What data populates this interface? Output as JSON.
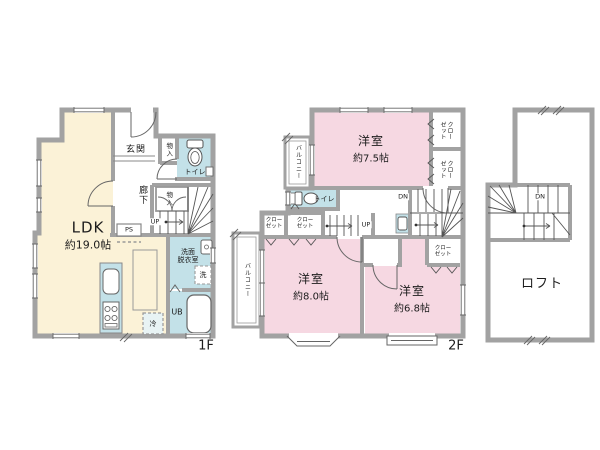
{
  "colors": {
    "room_cream": "#fbf2d7",
    "room_pink": "#f6d8e2",
    "wet_teal": "#c3e1e8",
    "wall_gray": "#a2a2a2",
    "text": "#1c1c1c"
  },
  "floor1": {
    "floor_label": "1F",
    "ldk_name": "LDK",
    "ldk_area": "約19.0帖",
    "entrance": "玄関",
    "entrance_storage": "物入",
    "toilet": "トイレ",
    "hallway": "廊下",
    "stair_storage": "物入",
    "up": "UP",
    "ps": "PS",
    "washroom": "洗面\n脱衣室",
    "washer": "洗",
    "unit_bath": "UB",
    "fridge": "冷"
  },
  "floor2": {
    "floor_label": "2F",
    "room_75_name": "洋室",
    "room_75_area": "約7.5帖",
    "room_80_name": "洋室",
    "room_80_area": "約8.0帖",
    "room_68_name": "洋室",
    "room_68_area": "約6.8帖",
    "balcony_top": "バルコニー",
    "balcony_bottom": "バルコニー",
    "toilet": "トイレ",
    "closet_top_right_1": "クローゼット",
    "closet_top_right_2": "クローゼット",
    "closet_hall_1": "クロー\nゼット",
    "closet_hall_2": "クロー\nゼット",
    "closet_68": "クロー\nゼット",
    "up": "UP",
    "dn": "DN"
  },
  "loft": {
    "name": "ロフト",
    "dn": "DN"
  }
}
